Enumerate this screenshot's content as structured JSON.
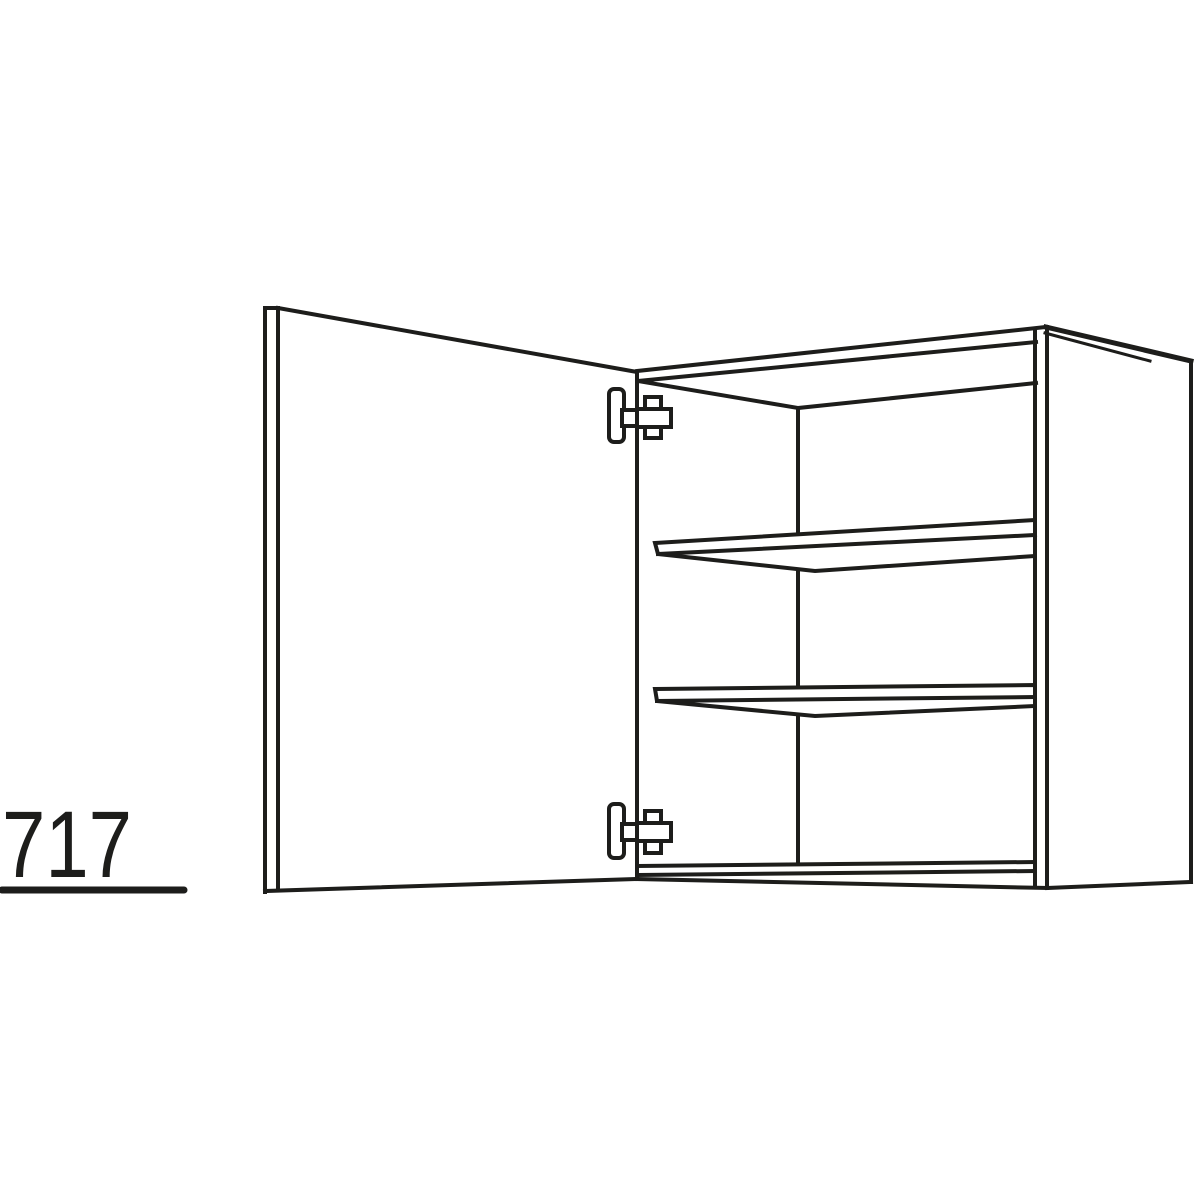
{
  "diagram": {
    "type": "technical-line-drawing",
    "subject": "Wall cabinet with open hinged door, two interior shelves and two concealed cup hinges",
    "dimension_label": "717",
    "colors": {
      "line": "#1d1d1b",
      "background": "#ffffff"
    }
  }
}
